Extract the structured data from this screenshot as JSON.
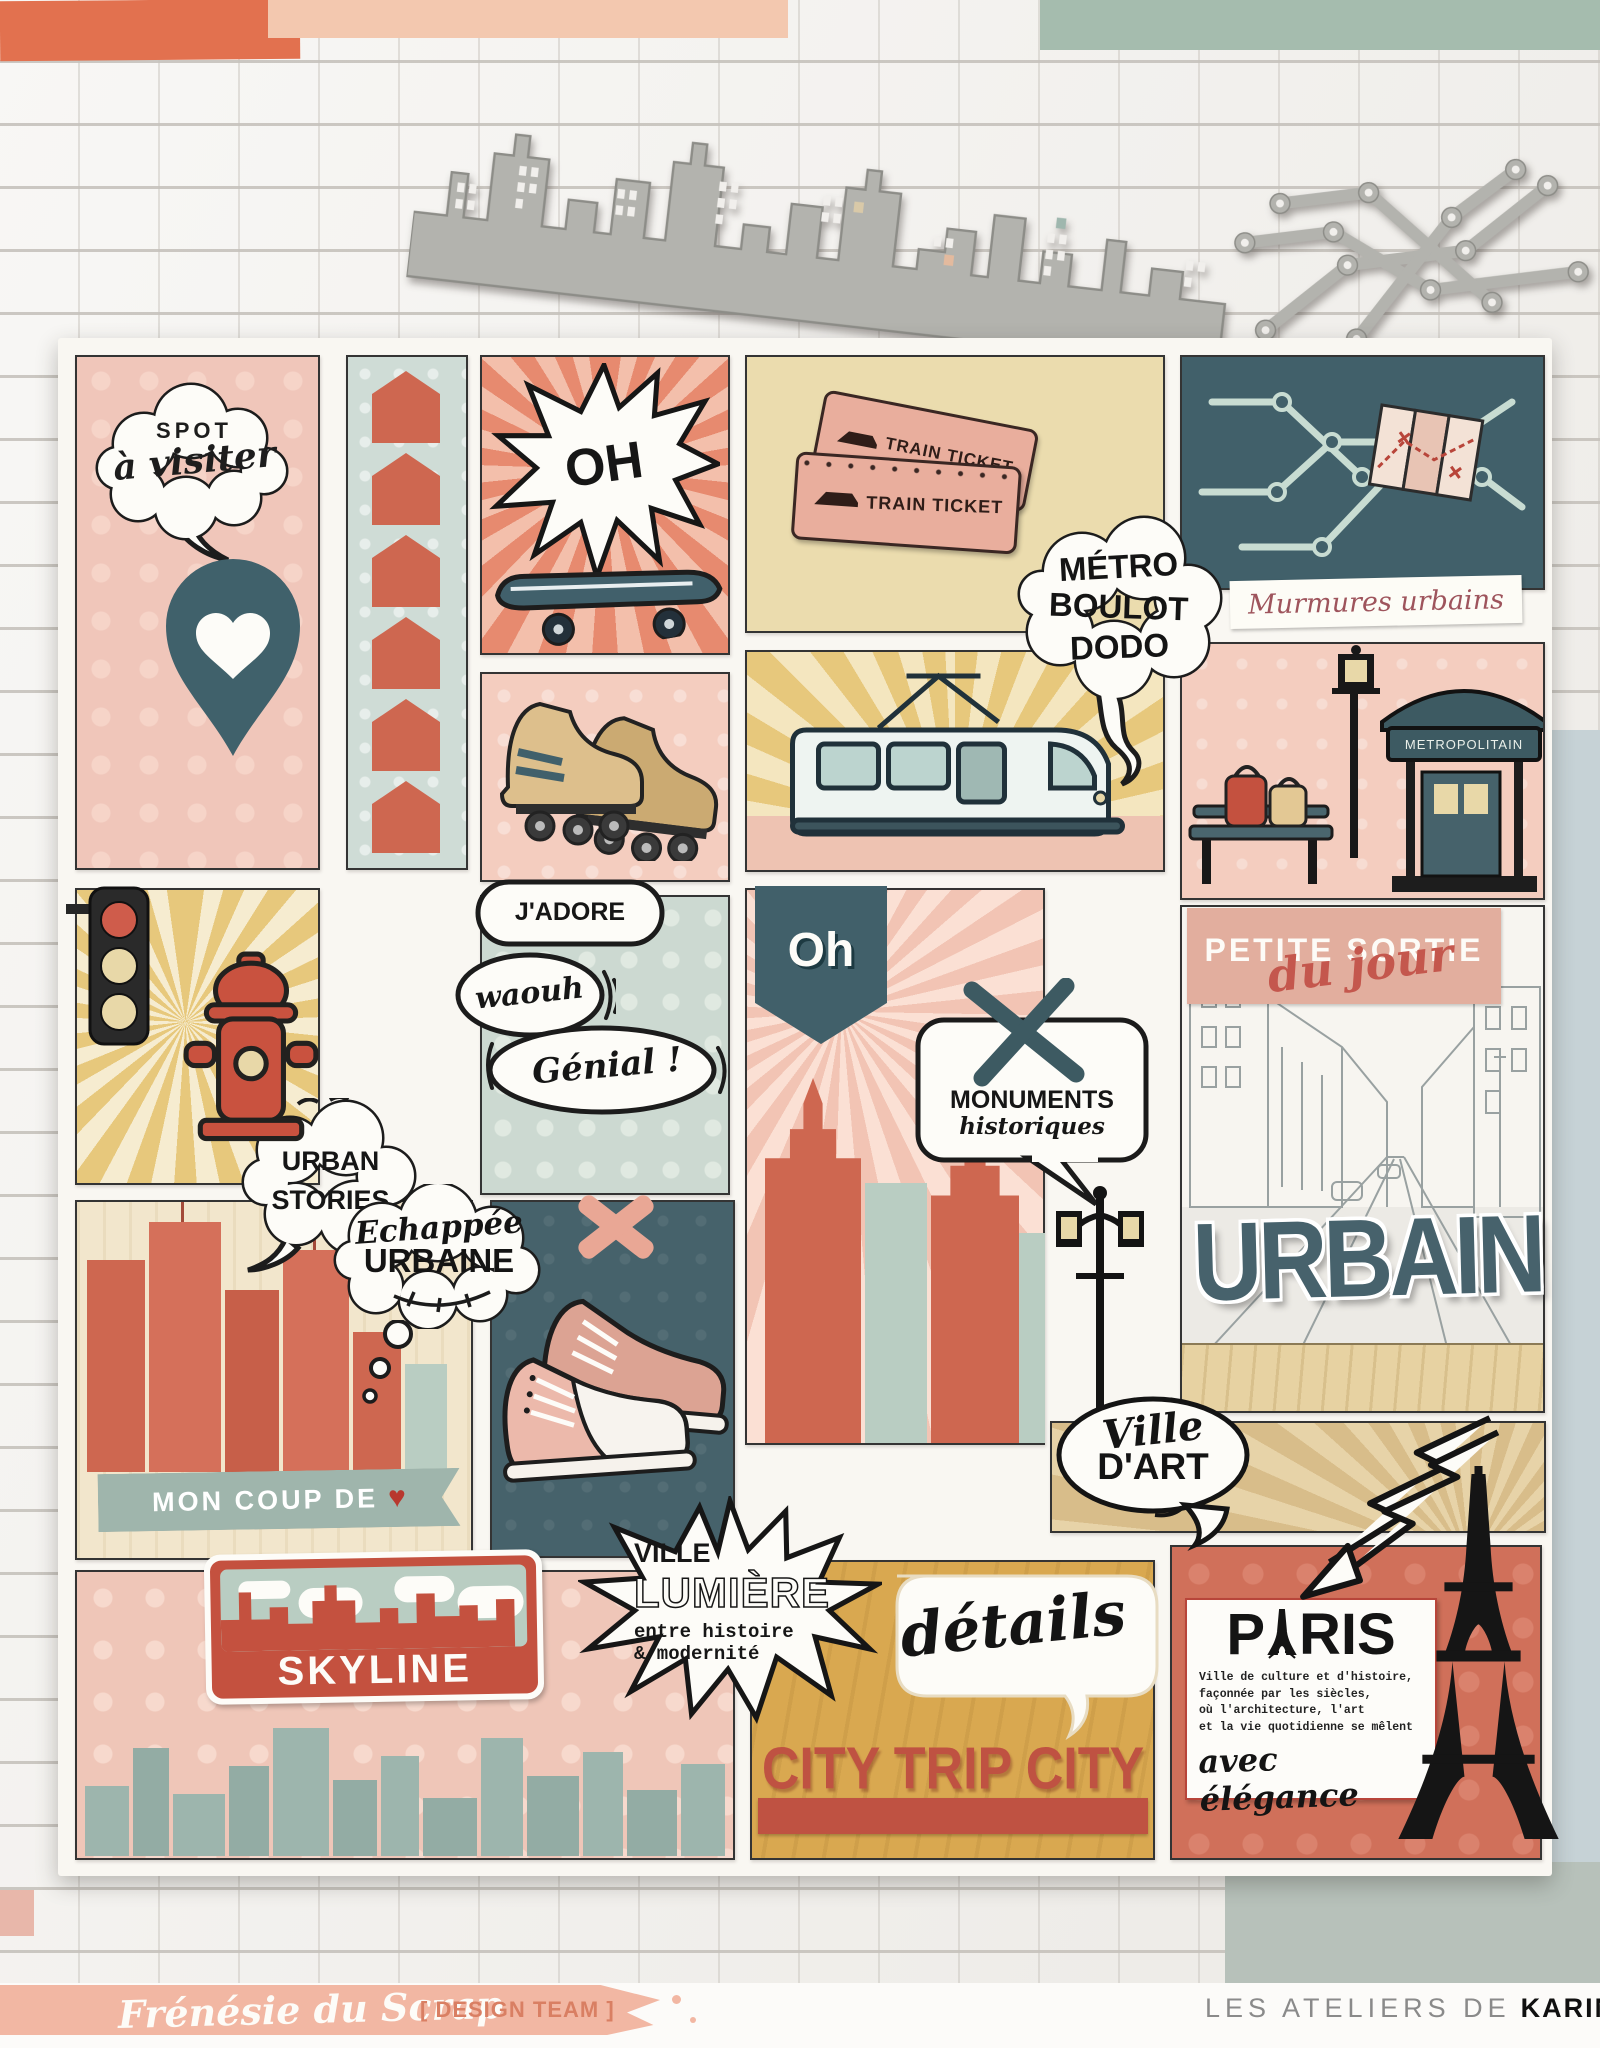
{
  "page": {
    "spot": {
      "l1": "SPOT",
      "l2": "à visiter"
    },
    "urban_stories": {
      "l1": "URBAN",
      "l2": "STORIES"
    },
    "oh_burst": {
      "label": "OH"
    },
    "tickets": {
      "label": "TRAIN TICKET"
    },
    "metro_bubble": {
      "l1": "MÉTRO",
      "l2": "BOULOT",
      "l3": "DODO"
    },
    "murmures": {
      "label": "Murmures urbains"
    },
    "jadore": {
      "label": "J'ADORE"
    },
    "waouh": {
      "label": "waouh"
    },
    "genial": {
      "label": "Génial !"
    },
    "oh_pennant": {
      "label": "Oh"
    },
    "monuments": {
      "l1": "MONUMENTS",
      "l2": "historiques"
    },
    "petite_sortie": {
      "l1": "PETITE SORTIE",
      "l2": "du jour"
    },
    "urbain": {
      "label": "URBAIN"
    },
    "kiosk": {
      "sign": "METROPOLITAIN"
    },
    "echappee": {
      "l1": "Echappée",
      "l2": "URBAINE"
    },
    "mon_coup": {
      "label": "MON COUP DE",
      "heart": "♥"
    },
    "skyline_sign": {
      "label": "SKYLINE"
    },
    "ville_lumiere": {
      "l1": "VILLE",
      "l2": "LUMIÈRE",
      "l3": "entre histoire",
      "l4": "& modernité"
    },
    "details": {
      "label": "détails"
    },
    "ville_dart": {
      "l1": "Ville",
      "l2": "D'ART"
    },
    "city_trip": {
      "label": "CITY TRIP CITY"
    },
    "paris": {
      "p": "P",
      "ris": "RIS",
      "body1": "Ville de culture et d'histoire,",
      "body2": "façonnée par les siècles,",
      "body3": "où l'architecture, l'art",
      "body4": "et la vie quotidienne se mêlent",
      "script": "avec élégance"
    }
  },
  "footer": {
    "brand": "Frénésie du Scrap",
    "team": "[ DESIGN TEAM ]",
    "studio": "LES ATELIERS DE",
    "studio_bold": "KARINE"
  },
  "colors": {
    "coral": "#d06a52",
    "pink": "#f0c6ba",
    "mint": "#cfdcd6",
    "teal_dark": "#41606a",
    "cream": "#ebdcae",
    "gold": "#d9a850",
    "sage": "#9fb7ae",
    "red_sign": "#c4513f",
    "paper": "#f8f6f1"
  }
}
